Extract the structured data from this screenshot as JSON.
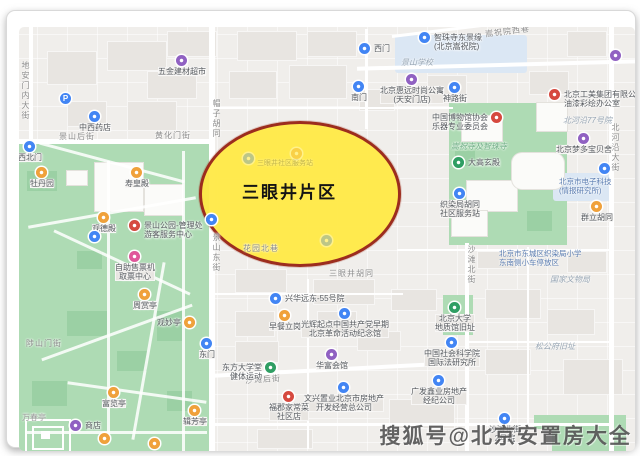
{
  "stage": {
    "watermark": "搜狐号@北京安置房大全"
  },
  "map": {
    "highlight": {
      "label": "三眼井片区",
      "fill": "#ffe946",
      "border": "#9c2d1e"
    },
    "colors": {
      "blue": "#4285f4",
      "purple": "#9061c2",
      "orange": "#f0a13b",
      "red": "#d6493f",
      "green": "#2f9e63",
      "pink": "#e0569a"
    },
    "streets": [
      {
        "t": "地安门内大街",
        "x": 13,
        "y": 50,
        "v": 1
      },
      {
        "t": "帽子胡同",
        "x": 204,
        "y": 88,
        "v": 1
      },
      {
        "t": "景山东街",
        "x": 204,
        "y": 222,
        "v": 1
      },
      {
        "t": "北河沿大街",
        "x": 603,
        "y": 112,
        "v": 1
      },
      {
        "t": "沙滩北街",
        "x": 459,
        "y": 234,
        "v": 1
      },
      {
        "t": "景山后街",
        "x": 52,
        "y": 120
      },
      {
        "t": "黄化门街",
        "x": 148,
        "y": 119
      },
      {
        "t": "沙滩后街",
        "x": 238,
        "y": 363,
        "rot": -4
      },
      {
        "t": "嵩祝院西巷",
        "x": 478,
        "y": 15,
        "rot": -7
      },
      {
        "t": "陟山门街",
        "x": 19,
        "y": 327
      },
      {
        "t": "三眼井胡同",
        "x": 322,
        "y": 257
      },
      {
        "t": "花园北巷",
        "x": 236,
        "y": 232
      }
    ],
    "areas": [
      {
        "t": "景山学校",
        "x": 394,
        "y": 47
      },
      {
        "t": "北河沿77号院",
        "x": 556,
        "y": 105
      },
      {
        "t": "国家文物局",
        "x": 543,
        "y": 264
      },
      {
        "lines": [
          "北京市电子科技",
          "(情报研究所)"
        ],
        "x": 552,
        "y": 166,
        "cls": "bluelabel"
      },
      {
        "t": "松公府旧址",
        "x": 528,
        "y": 331
      },
      {
        "t": "嵩祝寺及智珠寺",
        "x": 444,
        "y": 131,
        "cls": "greenarea"
      },
      {
        "lines": [
          "北京市东城区织染局小学",
          "东南侧小车停放区"
        ],
        "x": 492,
        "y": 238,
        "cls": "bluelabel"
      },
      {
        "t": "万春亭",
        "x": 15,
        "y": 402,
        "cls": "graylabel"
      },
      {
        "t": "三眼井社区服务站",
        "x": 250,
        "y": 149,
        "cls": "ghosttext"
      }
    ],
    "pois": [
      {
        "x": 23,
        "y": 136,
        "c": "blue",
        "lines": [
          "西北门"
        ],
        "lp": "b"
      },
      {
        "x": 35,
        "y": 162,
        "c": "orange",
        "lines": [
          "牡丹园"
        ],
        "lp": "b"
      },
      {
        "x": 130,
        "y": 162,
        "c": "orange",
        "lines": [
          "寿皇殿"
        ],
        "lp": "b"
      },
      {
        "x": 97,
        "y": 207,
        "c": "orange",
        "lines": [
          "观德殿"
        ],
        "lp": "b"
      },
      {
        "x": 128,
        "y": 215,
        "c": "red",
        "lines": [
          "景山公园-管理处",
          "游客服务中心"
        ],
        "lp": "r"
      },
      {
        "x": 128,
        "y": 246,
        "c": "pink",
        "lines": [
          "自助售票机",
          "取票中心"
        ],
        "lp": "b"
      },
      {
        "x": 88,
        "y": 226,
        "c": "blue",
        "lines": [],
        "lp": "b"
      },
      {
        "x": 138,
        "y": 284,
        "c": "orange",
        "lines": [
          "周赏亭"
        ],
        "lp": "b"
      },
      {
        "x": 183,
        "y": 312,
        "c": "orange",
        "lines": [
          "观妙亭"
        ],
        "lp": "l"
      },
      {
        "x": 200,
        "y": 333,
        "c": "blue",
        "lines": [
          "东门"
        ],
        "lp": "b"
      },
      {
        "x": 107,
        "y": 382,
        "c": "orange",
        "lines": [
          "富览亭"
        ],
        "lp": "b"
      },
      {
        "x": 188,
        "y": 400,
        "c": "orange",
        "lines": [
          "辑芳亭"
        ],
        "lp": "b"
      },
      {
        "x": 69,
        "y": 415,
        "c": "purple",
        "lines": [
          "商店"
        ],
        "lp": "r"
      },
      {
        "x": 98,
        "y": 428,
        "c": "orange",
        "lines": [],
        "lp": "b"
      },
      {
        "x": 148,
        "y": 433,
        "c": "orange",
        "lines": [],
        "lp": "b"
      },
      {
        "x": 175,
        "y": 50,
        "c": "purple",
        "lines": [
          "五金建材超市"
        ],
        "lp": "b"
      },
      {
        "x": 59,
        "y": 88,
        "c": "blue",
        "glyph": "P",
        "lines": [],
        "lp": "b"
      },
      {
        "x": 88,
        "y": 106,
        "c": "blue",
        "lines": [
          "中西药店"
        ],
        "lp": "b"
      },
      {
        "x": 205,
        "y": 209,
        "c": "blue",
        "lines": [],
        "lp": "b"
      },
      {
        "x": 358,
        "y": 38,
        "c": "blue",
        "lines": [
          "西门"
        ],
        "lp": "r"
      },
      {
        "x": 418,
        "y": 27,
        "c": "blue",
        "lines": [
          "智珠寺东景缘",
          "(北京嵩祝院)"
        ],
        "lp": "r"
      },
      {
        "x": 405,
        "y": 69,
        "c": "purple",
        "lines": [
          "北京惠远时尚公寓",
          "(天安门店)"
        ],
        "lp": "b"
      },
      {
        "x": 352,
        "y": 76,
        "c": "blue",
        "lines": [
          "南门"
        ],
        "lp": "b"
      },
      {
        "x": 448,
        "y": 77,
        "c": "blue",
        "lines": [
          "神路街"
        ],
        "lp": "b"
      },
      {
        "x": 490,
        "y": 107,
        "c": "red",
        "lines": [
          "中国博物馆协会",
          "乐器专业委员会"
        ],
        "lp": "l"
      },
      {
        "x": 452,
        "y": 152,
        "c": "green",
        "lines": [
          "大高玄殿"
        ],
        "lp": "r"
      },
      {
        "x": 453,
        "y": 183,
        "c": "blue",
        "lines": [
          "织染局胡同",
          "社区服务站"
        ],
        "lp": "b"
      },
      {
        "x": 548,
        "y": 84,
        "c": "red",
        "lines": [
          "北京工美集团有限公司",
          "油漆彩绘办公室"
        ],
        "lp": "r"
      },
      {
        "x": 609,
        "y": 45,
        "c": "purple",
        "lines": [],
        "lp": "b"
      },
      {
        "x": 577,
        "y": 128,
        "c": "purple",
        "lines": [
          "北京梦多宝贝舍"
        ],
        "lp": "b"
      },
      {
        "x": 598,
        "y": 158,
        "c": "blue",
        "lines": [],
        "lp": "b"
      },
      {
        "x": 590,
        "y": 196,
        "c": "orange",
        "lines": [
          "群立胡同"
        ],
        "lp": "b"
      },
      {
        "x": 269,
        "y": 288,
        "c": "blue",
        "lines": [
          "兴华远东-55号院"
        ],
        "lp": "r"
      },
      {
        "x": 278,
        "y": 305,
        "c": "orange",
        "lines": [
          "早餐立岗"
        ],
        "lp": "b"
      },
      {
        "x": 338,
        "y": 303,
        "c": "blue",
        "lines": [
          "光辉起点中国共产党早期",
          "北京革命活动纪念馆"
        ],
        "lp": "b"
      },
      {
        "x": 264,
        "y": 357,
        "c": "green",
        "lines": [
          "东方大学堂",
          "健体运动"
        ],
        "lp": "l"
      },
      {
        "x": 325,
        "y": 344,
        "c": "purple",
        "lines": [
          "华富会馆"
        ],
        "lp": "b"
      },
      {
        "x": 337,
        "y": 377,
        "c": "blue",
        "lines": [
          "文兴置业北京市房地产",
          "开发经营总公司"
        ],
        "lp": "b"
      },
      {
        "x": 282,
        "y": 386,
        "c": "red",
        "lines": [
          "福郡家常菜",
          "社区店"
        ],
        "lp": "b"
      },
      {
        "x": 432,
        "y": 370,
        "c": "blue",
        "lines": [
          "广发鑫业房地产",
          "经纪公司"
        ],
        "lp": "b"
      },
      {
        "x": 498,
        "y": 408,
        "c": "blue",
        "lines": [
          "沙滩北街",
          "2号院"
        ],
        "lp": "b"
      },
      {
        "x": 448,
        "y": 297,
        "c": "green",
        "lines": [
          "北京大学",
          "地质馆旧址"
        ],
        "lp": "b"
      },
      {
        "x": 445,
        "y": 332,
        "c": "blue",
        "lines": [
          "中国社会科学院",
          "国际法研究所"
        ],
        "lp": "b"
      }
    ],
    "ghosts": [
      {
        "x": 242,
        "y": 148,
        "c": "blue"
      },
      {
        "x": 290,
        "y": 143,
        "c": "orange"
      },
      {
        "x": 320,
        "y": 230,
        "c": "blue"
      }
    ]
  }
}
